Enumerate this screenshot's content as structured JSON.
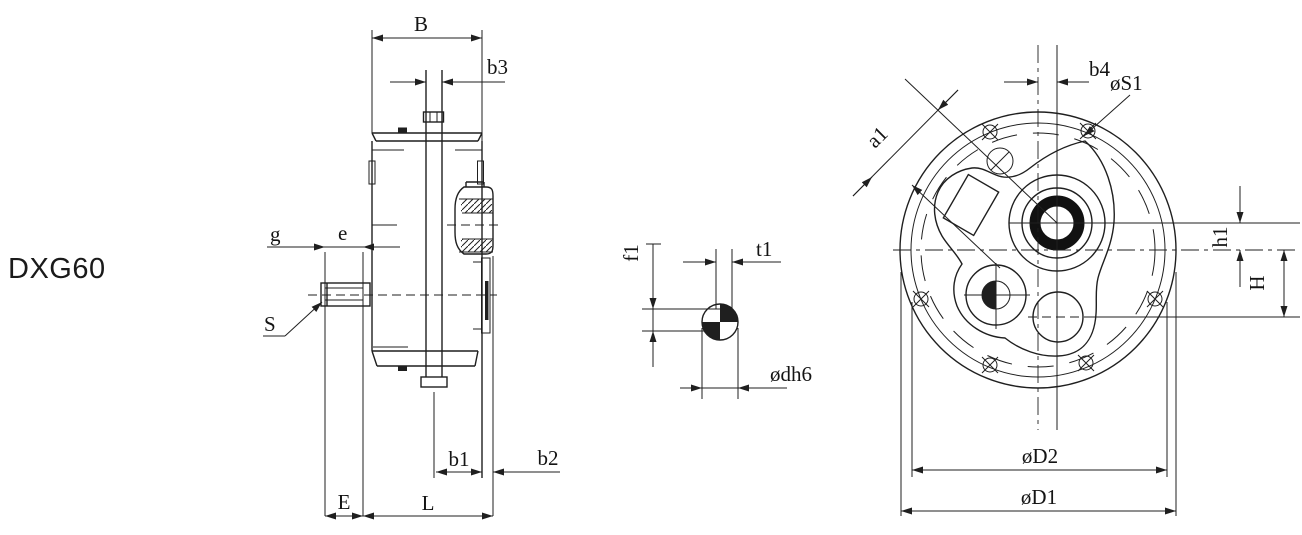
{
  "model_label": "DXG60",
  "colors": {
    "line": "#1f1f1f",
    "background": "#ffffff"
  },
  "side_view": {
    "dims": {
      "B": "B",
      "b3": "b3",
      "g": "g",
      "e": "e",
      "S": "S",
      "b1": "b1",
      "b2": "b2",
      "E": "E",
      "L": "L"
    }
  },
  "shaft_section": {
    "dims": {
      "f1": "f1",
      "t1": "t1",
      "d": "ødh6"
    }
  },
  "front_view": {
    "dims": {
      "b4": "b4",
      "S1": "øS1",
      "a1": "a1",
      "h1": "h1",
      "H": "H",
      "D2": "øD2",
      "D1": "øD1"
    }
  }
}
